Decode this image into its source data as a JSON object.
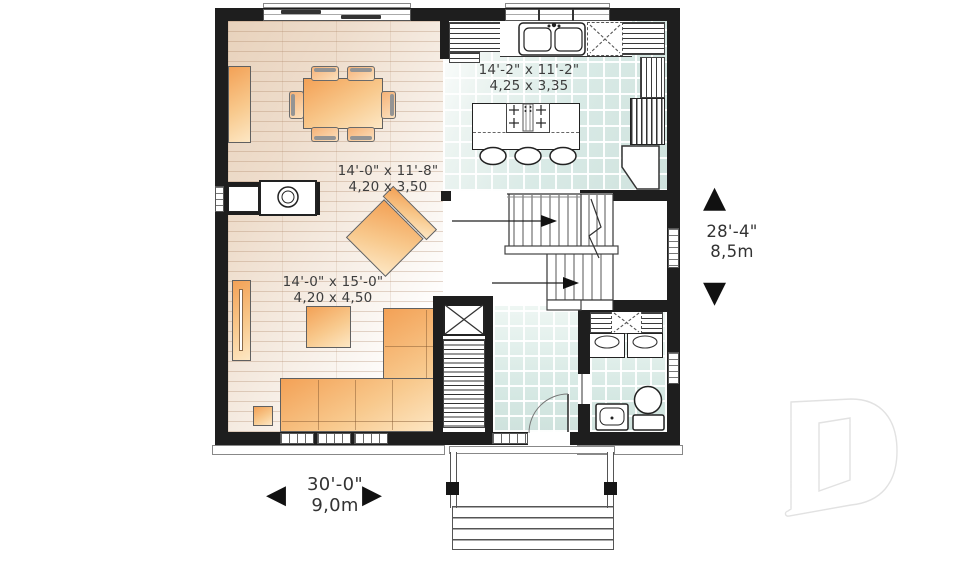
{
  "plan": {
    "rooms": {
      "kitchen": {
        "label_imperial": "14'-2\" x 11'-2\"",
        "label_metric": "4,25 x 3,35"
      },
      "dining": {
        "label_imperial": "14'-0\" x 11'-8\"",
        "label_metric": "4,20 x 3,50"
      },
      "living": {
        "label_imperial": "14'-0\" x 15'-0\"",
        "label_metric": "4,20 x 4,50"
      }
    },
    "overall": {
      "width_imperial": "30'-0\"",
      "width_metric": "9,0m",
      "depth_imperial": "28'-4\"",
      "depth_metric": "8,5m"
    }
  },
  "icons": {
    "arrow_up": "▲",
    "arrow_down": "▼",
    "arrow_left": "◀",
    "arrow_right": "▶"
  },
  "colors": {
    "wall": "#1e1e1e",
    "furniture_accent": "#f5a85f",
    "tile": "#d9eae6",
    "wood": "#ead6c3",
    "logo_outline": "#e2e2e2"
  }
}
